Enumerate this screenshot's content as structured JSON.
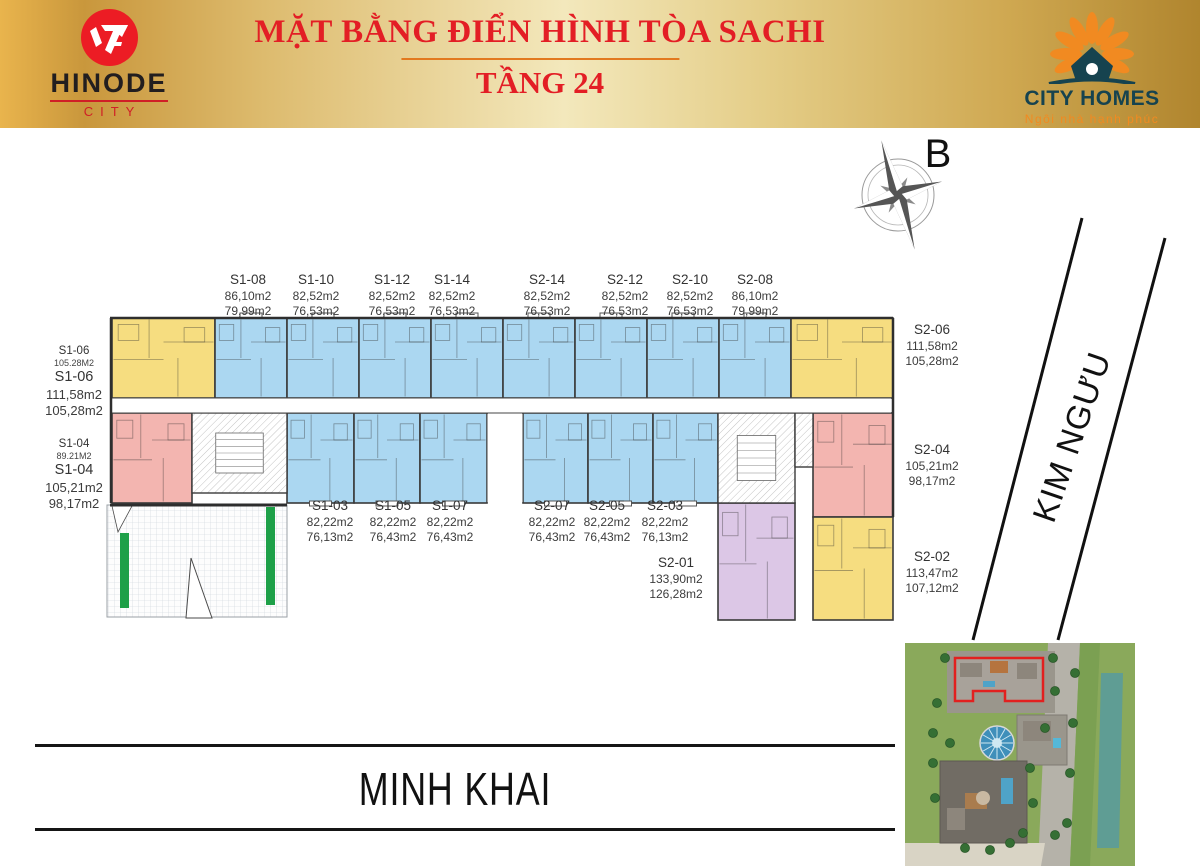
{
  "header": {
    "hinode": {
      "name": "HINODE",
      "sub": "CITY"
    },
    "title": "MẶT BẰNG ĐIỂN HÌNH TÒA SACHI",
    "subtitle": "TẦNG 24",
    "cityhomes": {
      "name": "CITY HOMES",
      "tagline": "Ngôi nhà hạnh phúc"
    }
  },
  "compass": {
    "label": "B"
  },
  "streets": {
    "bottom": "MINH KHAI",
    "right": "KIM NGƯU"
  },
  "colors": {
    "unit_yellow": "#f6dd80",
    "unit_blue": "#abd7f1",
    "unit_pink": "#f3b5b0",
    "unit_purple": "#dcc7e6",
    "wall": "#3a3a3a",
    "green_bar": "#1ea048",
    "title_red": "#e31e25",
    "cityhomes_teal": "#16434f",
    "cityhomes_orange": "#f18a21"
  },
  "unit_labels": [
    {
      "id": "S1-08",
      "area1": "86,10m2",
      "area2": "79,99m2",
      "pos": "top"
    },
    {
      "id": "S1-10",
      "area1": "82,52m2",
      "area2": "76,53m2",
      "pos": "top"
    },
    {
      "id": "S1-12",
      "area1": "82,52m2",
      "area2": "76,53m2",
      "pos": "top"
    },
    {
      "id": "S1-14",
      "area1": "82,52m2",
      "area2": "76,53m2",
      "pos": "top"
    },
    {
      "id": "S2-14",
      "area1": "82,52m2",
      "area2": "76,53m2",
      "pos": "top"
    },
    {
      "id": "S2-12",
      "area1": "82,52m2",
      "area2": "76,53m2",
      "pos": "top"
    },
    {
      "id": "S2-10",
      "area1": "82,52m2",
      "area2": "76,53m2",
      "pos": "top"
    },
    {
      "id": "S2-08",
      "area1": "86,10m2",
      "area2": "79,99m2",
      "pos": "top"
    },
    {
      "id": "S1-06",
      "plan_area": "105.28M2",
      "area1": "111,58m2",
      "area2": "105,28m2",
      "pos": "left"
    },
    {
      "id": "S1-04",
      "plan_area": "89.21M2",
      "area1": "105,21m2",
      "area2": "98,17m2",
      "pos": "left"
    },
    {
      "id": "S2-06",
      "area1": "111,58m2",
      "area2": "105,28m2",
      "pos": "right"
    },
    {
      "id": "S2-04",
      "area1": "105,21m2",
      "area2": "98,17m2",
      "pos": "right"
    },
    {
      "id": "S2-02",
      "area1": "113,47m2",
      "area2": "107,12m2",
      "pos": "right"
    },
    {
      "id": "S1-03",
      "area1": "82,22m2",
      "area2": "76,13m2",
      "pos": "bottom"
    },
    {
      "id": "S1-05",
      "area1": "82,22m2",
      "area2": "76,43m2",
      "pos": "bottom"
    },
    {
      "id": "S1-07",
      "area1": "82,22m2",
      "area2": "76,43m2",
      "pos": "bottom"
    },
    {
      "id": "S2-07",
      "area1": "82,22m2",
      "area2": "76,43m2",
      "pos": "bottom"
    },
    {
      "id": "S2-05",
      "area1": "82,22m2",
      "area2": "76,43m2",
      "pos": "bottom"
    },
    {
      "id": "S2-03",
      "area1": "82,22m2",
      "area2": "76,13m2",
      "pos": "bottom"
    },
    {
      "id": "S2-01",
      "area1": "133,90m2",
      "area2": "126,28m2",
      "pos": "mid"
    }
  ]
}
